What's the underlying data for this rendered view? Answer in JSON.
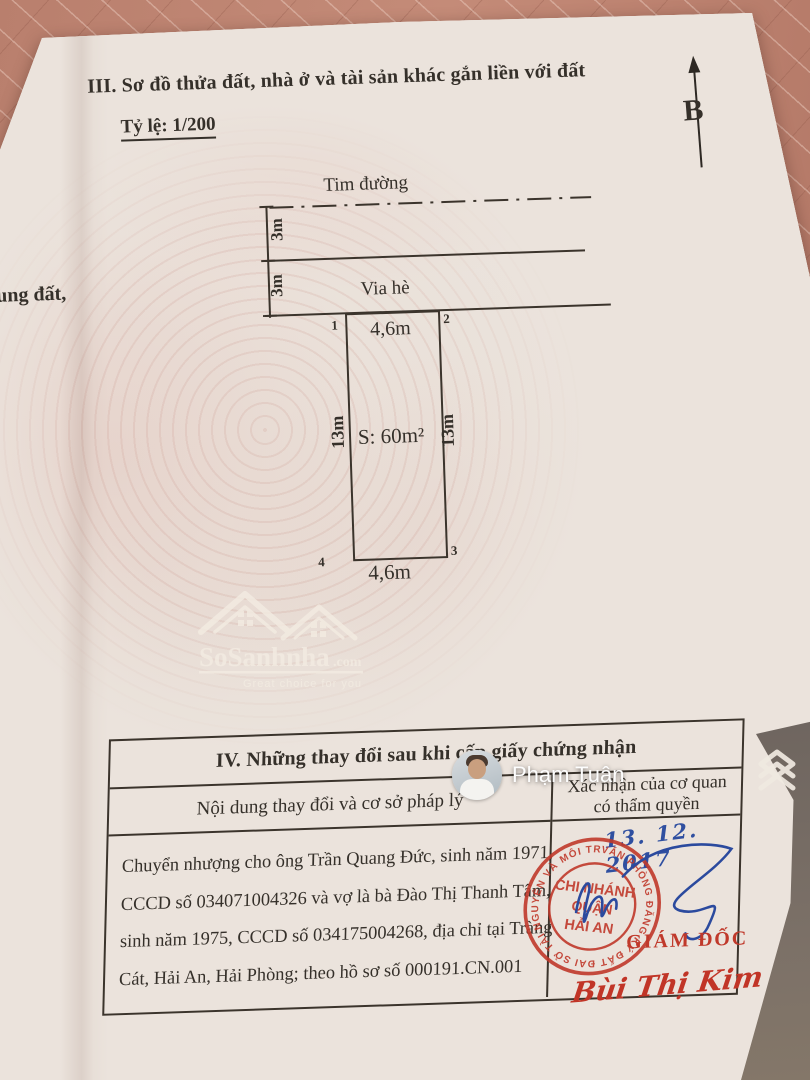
{
  "document": {
    "section_iii": {
      "title": "III. Sơ đồ thửa đất, nhà ở và tài sản khác gắn liền với đất",
      "scale_note": "Tỷ lệ: 1/200",
      "left_page_fragment": "ung đất,",
      "north_label": "B",
      "diagram": {
        "road_centerline_label": "Tim đường",
        "sidewalk_label": "Via hè",
        "road_half_width": "3m",
        "sidewalk_width": "3m",
        "front_edge": "4,6m",
        "rear_edge": "4,6m",
        "left_edge": "13m",
        "right_edge": "13m",
        "area_label": "S: 60m²",
        "corner_1": "1",
        "corner_2": "2",
        "corner_3": "3",
        "corner_4": "4"
      }
    },
    "section_iv": {
      "title": "IV. Những thay đổi sau khi cấp giấy chứng nhận",
      "left_column_header": "Nội dung thay đổi và cơ sở pháp lý",
      "right_column_header_line1": "Xác nhận của cơ quan",
      "right_column_header_line2": "có thẩm quyền",
      "change_note_lines": [
        "Chuyển nhượng cho ông Trần Quang Đức, sinh năm 1971,",
        "CCCD số 034071004326 và vợ là bà Đào Thị Thanh Tâm,",
        "sinh năm 1975, CCCD số 034175004268, địa chỉ tại Tràng",
        "Cát, Hải An, Hải Phòng; theo hồ sơ số 000191.CN.001"
      ],
      "handwritten_date": "13. 12. 2017",
      "stamp": {
        "ring_text": "VĂN PHÒNG ĐĂNG KÝ ĐẤT ĐAI SỞ TÀI NGUYÊN VÀ MÔI TRƯỜNG T.P HẢI PHÒNG ★",
        "line1": "CHI NHÁNH",
        "line2": "QUẬN",
        "line3": "HẢI AN"
      },
      "signer_title": "GIÁM ĐỐC",
      "signer_name": "Bùi Thị Kim Oanh"
    }
  },
  "overlays": {
    "caller_name": "Phạm Tuân",
    "watermark": {
      "brand": "SoSanhnha",
      "brand_suffix": ".com",
      "tagline": "Great choice for you"
    }
  },
  "colors": {
    "stamp_red": "#c0392b",
    "ink_blue": "#2f4fa0",
    "ink_black": "#3b342c"
  }
}
